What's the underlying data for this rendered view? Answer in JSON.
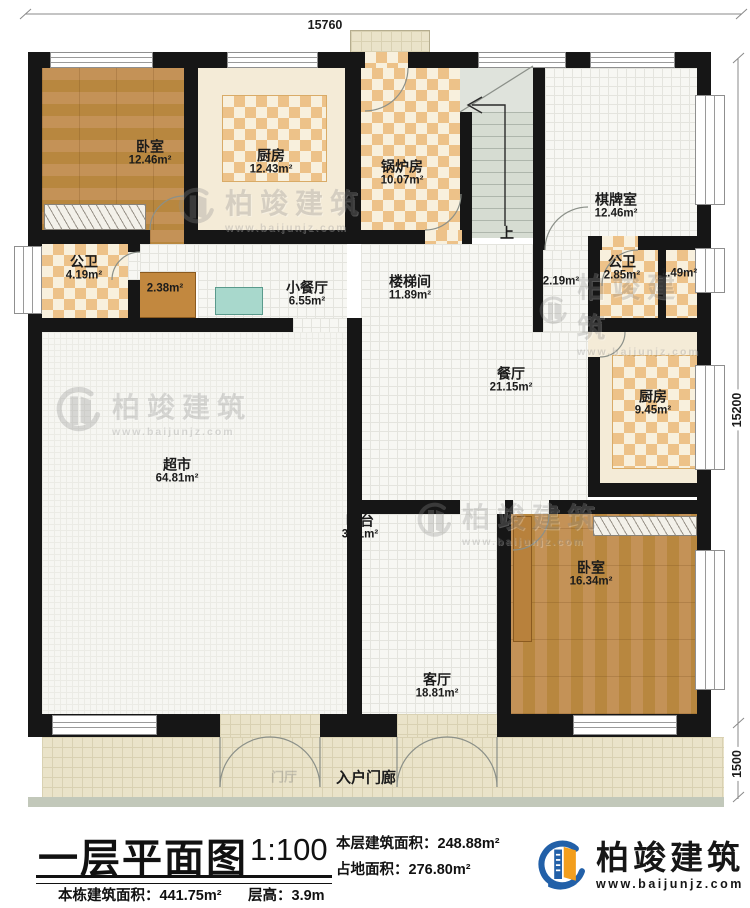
{
  "dimensions": {
    "top": "15760",
    "right": "15200",
    "porch": "1500"
  },
  "rooms": {
    "bedroom1": {
      "name": "卧室",
      "area": "12.46m²"
    },
    "kitchen1": {
      "name": "厨房",
      "area": "12.43m²"
    },
    "boiler": {
      "name": "锅炉房",
      "area": "10.07m²"
    },
    "chessroom": {
      "name": "棋牌室",
      "area": "12.46m²"
    },
    "bath1": {
      "name": "公卫",
      "area": "4.19m²"
    },
    "closet": {
      "area": "2.38m²"
    },
    "smalldining": {
      "name": "小餐厅",
      "area": "6.55m²"
    },
    "stairhall": {
      "name": "楼梯间",
      "area": "11.89m²"
    },
    "nook": {
      "area": "2.19m²"
    },
    "bath2": {
      "name": "公卫",
      "area": "2.85m²"
    },
    "shower": {
      "area": "1.49m²"
    },
    "dining": {
      "name": "餐厅",
      "area": "21.15m²"
    },
    "kitchen2": {
      "name": "厨房",
      "area": "9.45m²"
    },
    "supermarket": {
      "name": "超市",
      "area": "64.81m²"
    },
    "bar": {
      "name": "吧台",
      "area": "3.71m²"
    },
    "bedroom2": {
      "name": "卧室",
      "area": "16.34m²"
    },
    "living": {
      "name": "客厅",
      "area": "18.81m²"
    },
    "porch": {
      "name": "入户门廊"
    },
    "foyer_faint": {
      "name": "门厅"
    },
    "stair_up": {
      "name": "上"
    }
  },
  "watermark": {
    "name": "柏竣建筑",
    "url": "www.baijunjz.com"
  },
  "titleblock": {
    "title": "一层平面图",
    "scale": "1:100",
    "this_floor_area": "本层建筑面积：248.88m²",
    "footprint_area": "占地面积：276.80m²",
    "building_area": "本栋建筑面积：441.75m²",
    "floor_height": "层高：3.9m"
  },
  "brand": {
    "name": "柏竣建筑",
    "url": "www.baijunjz.com"
  },
  "colors": {
    "wall": "#161616",
    "checker": "#edc289",
    "wood": "#bb8650",
    "bed_blue": "#7cccdb",
    "porch": "#eae3c9",
    "logo_blue": "#2260a8",
    "logo_orange": "#f29e1d"
  }
}
